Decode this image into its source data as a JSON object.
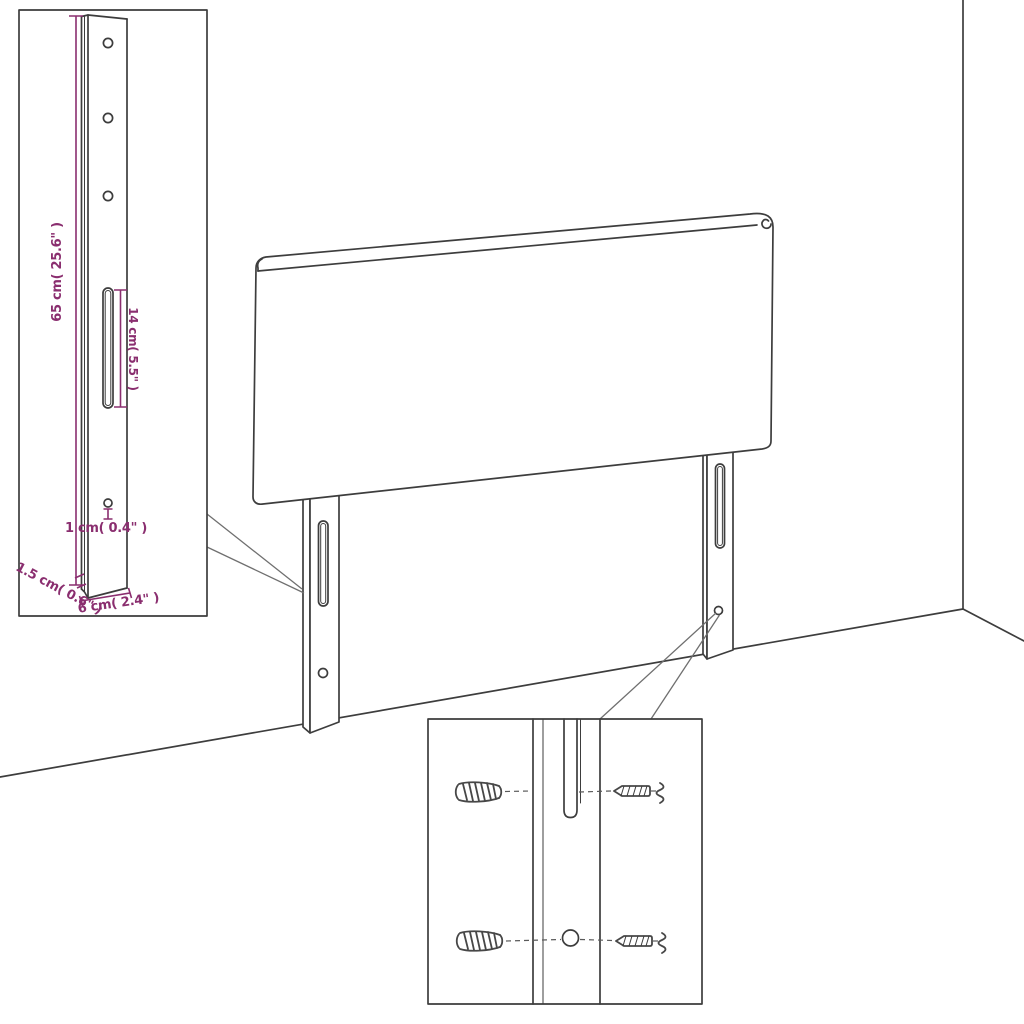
{
  "diagram": {
    "kind": "headboard-assembly-line-drawing",
    "colors": {
      "dimension": "#8a2e6f",
      "line": "#3d3d3d",
      "background": "#ffffff"
    },
    "labels": {
      "leg_height": "65 cm( 25.6\" )",
      "slot_length": "14 cm( 5.5\" )",
      "hole_diameter": "1 cm( 0.4\" )",
      "leg_thickness": "1.5 cm( 0.6\" )",
      "leg_width": "6 cm( 2.4\" )"
    }
  }
}
